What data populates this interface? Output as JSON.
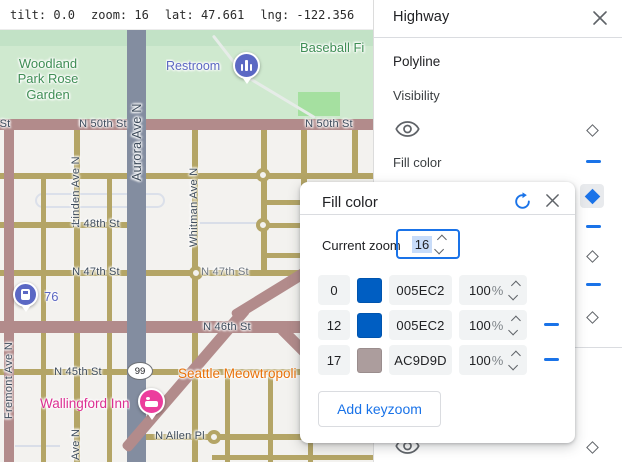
{
  "status_bar": {
    "tilt": "tilt: 0.0",
    "zoom": "zoom: 16",
    "lat": "lat: 47.661",
    "lng": "lng: -122.356"
  },
  "panel": {
    "title": "Highway",
    "polyline_section": "Polyline",
    "visibility_label": "Visibility",
    "fill_color_label": "Fill color"
  },
  "dialog": {
    "title": "Fill color",
    "current_zoom_label": "Current zoom",
    "current_zoom_value": "16",
    "add_keyzoom": "Add keyzoom",
    "rows": [
      {
        "zoom": "0",
        "hex": "005EC2",
        "swatch": "#005EC2",
        "opacity_value": "100",
        "pct": "%"
      },
      {
        "zoom": "12",
        "hex": "005EC2",
        "swatch": "#005EC2",
        "opacity_value": "100",
        "pct": "%"
      },
      {
        "zoom": "17",
        "hex": "AC9D9D",
        "swatch": "#AC9D9D",
        "opacity_value": "100",
        "pct": "%"
      }
    ]
  },
  "map": {
    "streets": {
      "n50_left": "N 50th St",
      "n50_right": "N 50th St",
      "st_fragment": "St",
      "n48": "N 48th St",
      "n47_left": "N 47th St",
      "n47_right": "N 47th St",
      "n46": "N 46th St",
      "n45": "N 45th St",
      "n_allen": "N Allen Pl",
      "aurora": "Aurora Ave N",
      "linden": "Linden Ave N",
      "linden_bottom": "Ave N",
      "whitman": "Whitman Ave N",
      "fremont": "Fremont Ave N",
      "hwy99": "99"
    },
    "pois": {
      "park": "Woodland Park Rose Garden",
      "restroom": "Restroom",
      "baseball": "Baseball Fi",
      "gas": "76",
      "inn": "Wallingford Inn",
      "cafe": "Seattle Meowtropoli"
    }
  },
  "colors": {
    "accent_blue": "#1a73e8",
    "keyzoom_swatch_blue": "#005EC2",
    "keyzoom_swatch_mauve": "#AC9D9D",
    "highway_road": "#838da0",
    "arterial_road": "#b28b8b",
    "minor_road": "#b4a566"
  }
}
